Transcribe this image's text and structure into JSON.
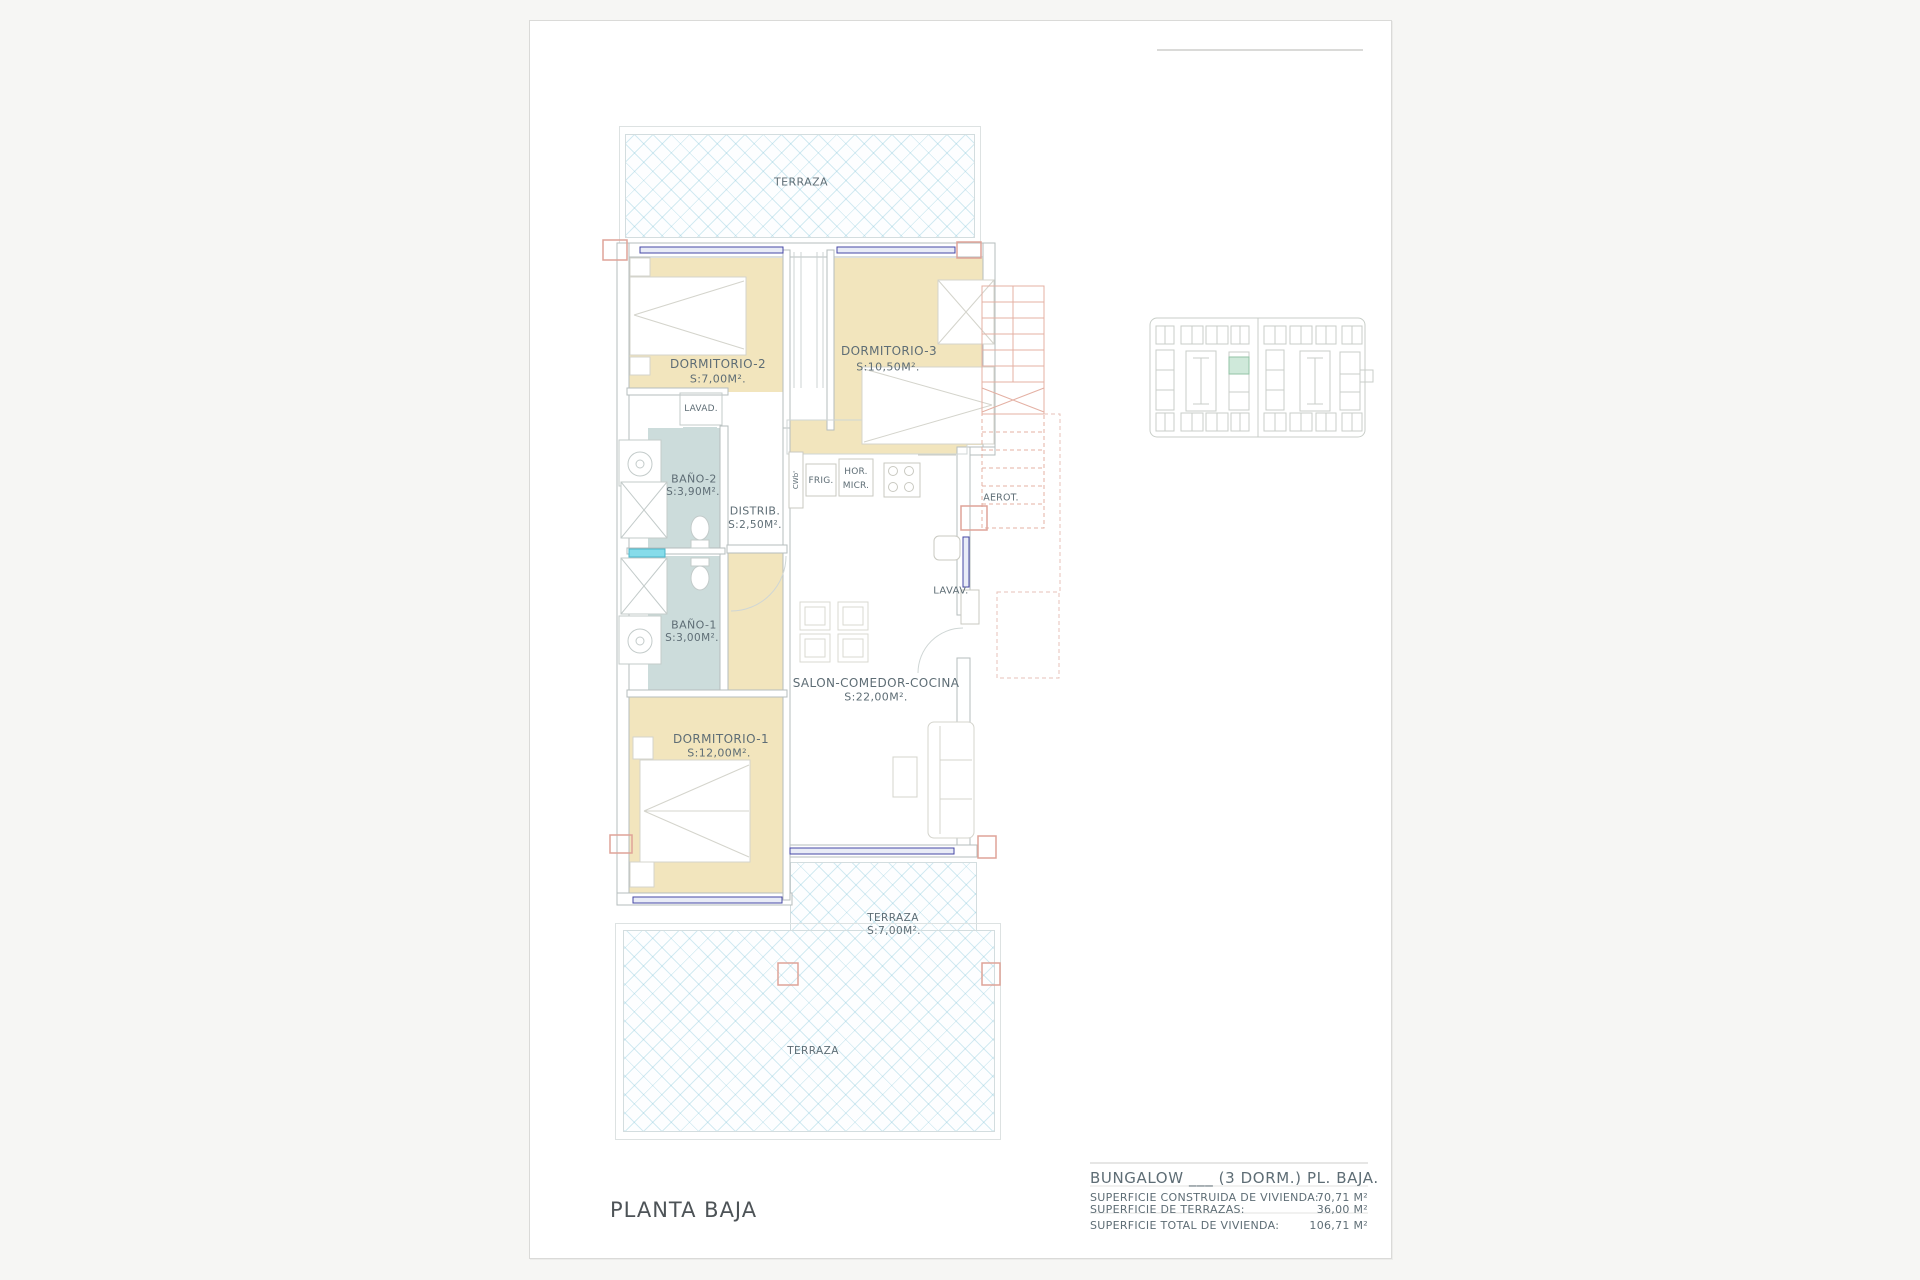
{
  "footer": {
    "plan_title": "PLANTA BAJA"
  },
  "title_block": {
    "title": "BUNGALOW ___ (3 DORM.)  PL. BAJA.",
    "rows": [
      {
        "label": "SUPERFICIE CONSTRUIDA DE VIVIENDA:",
        "value": "70,71 M²"
      },
      {
        "label": "SUPERFICIE DE TERRAZAS:",
        "value": "36,00 M²"
      },
      {
        "label": "SUPERFICIE TOTAL DE VIVIENDA:",
        "value": "106,71 M²"
      }
    ]
  },
  "rooms": {
    "terraza_top": {
      "name": "TERRAZA"
    },
    "dormitorio2": {
      "name": "DORMITORIO-2",
      "area": "S:7,00M²."
    },
    "dormitorio3": {
      "name": "DORMITORIO-3",
      "area": "S:10,50M²."
    },
    "lavadero": {
      "name": "LAVAD."
    },
    "bano2": {
      "name": "BAÑO-2",
      "area": "S:3,90M²."
    },
    "distribuidor": {
      "name": "DISTRIB.",
      "area": "S:2,50M²."
    },
    "bano1": {
      "name": "BAÑO-1",
      "area": "S:3,00M²."
    },
    "dormitorio1": {
      "name": "DORMITORIO-1",
      "area": "S:12,00M²."
    },
    "salon": {
      "name": "SALON-COMEDOR-COCINA",
      "area": "S:22,00M²."
    },
    "terraza_salon": {
      "name": "TERRAZA",
      "area": "S:7,00M²."
    },
    "terraza_bottom": {
      "name": "TERRAZA"
    }
  },
  "annotations": {
    "frig": "FRIG.",
    "hor": "HOR.",
    "micr": "MICR.",
    "cw": "CWb'",
    "aerot": "AEROT.",
    "lavav": "LAVAV."
  },
  "colors": {
    "room_fill": "#f2e5bd",
    "bath_fill": "#ccdcdb",
    "terrace_hatch_line": "#7dc3d7",
    "window_line": "#4547a5",
    "structure_accent": "#dfa398",
    "text": "#5e6d75",
    "site_highlight_unit": "#cfe9da"
  }
}
